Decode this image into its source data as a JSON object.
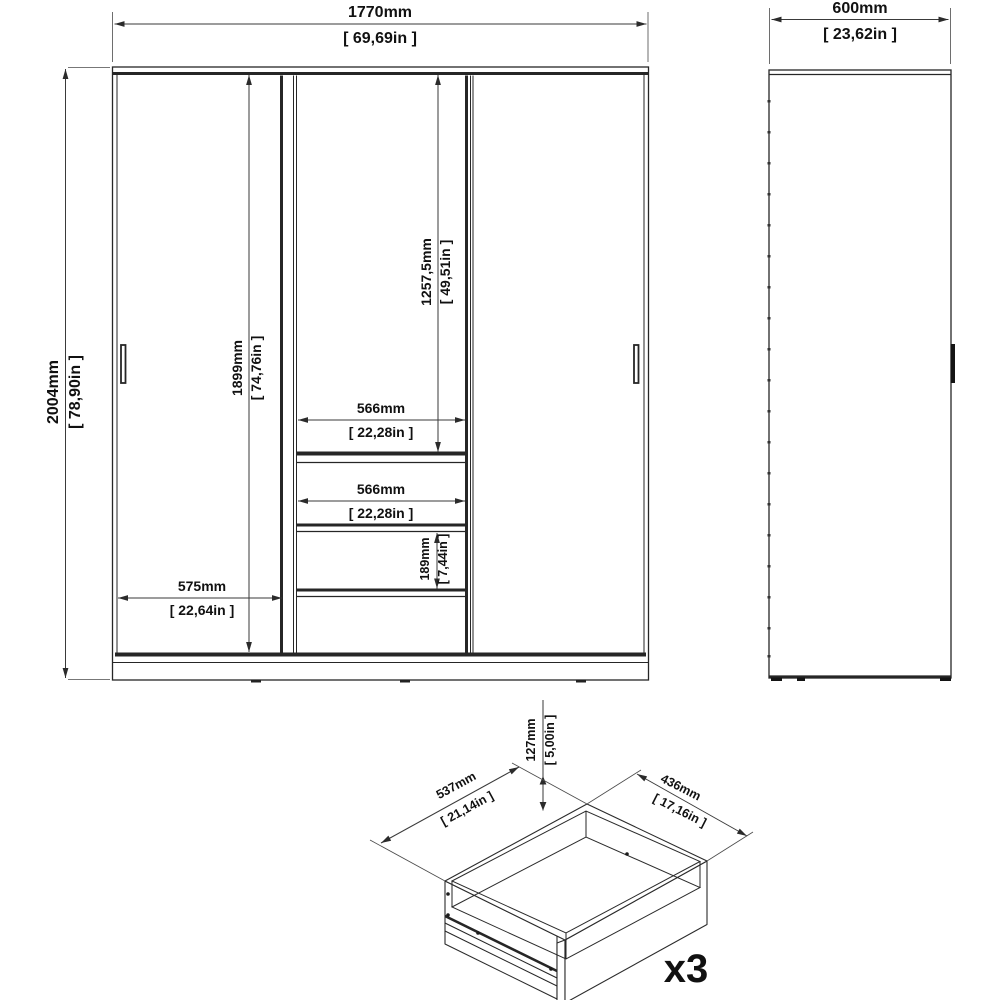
{
  "front_view": {
    "overall_width_mm": "1770mm",
    "overall_width_in": "[ 69,69in ]",
    "overall_height_mm": "2004mm",
    "overall_height_in": "[ 78,90in ]",
    "interior_height_mm": "1899mm",
    "interior_height_in": "[ 74,76in ]",
    "hanging_section_mm": "1257,5mm",
    "hanging_section_in": "[ 49,51in ]",
    "shelf_width_upper_mm": "566mm",
    "shelf_width_upper_in": "[ 22,28in ]",
    "shelf_width_lower_mm": "566mm",
    "shelf_width_lower_in": "[ 22,28in ]",
    "drawer_height_mm": "189mm",
    "drawer_height_in": "[ 7,44in ]",
    "door_width_mm": "575mm",
    "door_width_in": "[ 22,64in ]"
  },
  "side_view": {
    "depth_mm": "600mm",
    "depth_in": "[ 23,62in ]"
  },
  "drawer_detail": {
    "height_mm": "127mm",
    "height_in": "[ 5,00in ]",
    "depth_mm": "537mm",
    "depth_in": "[ 21,14in ]",
    "width_mm": "436mm",
    "width_in": "[ 17,16in ]",
    "quantity": "x3"
  },
  "colors": {
    "line": "#262626",
    "dimension": "#3a3a3a",
    "background": "#ffffff"
  }
}
